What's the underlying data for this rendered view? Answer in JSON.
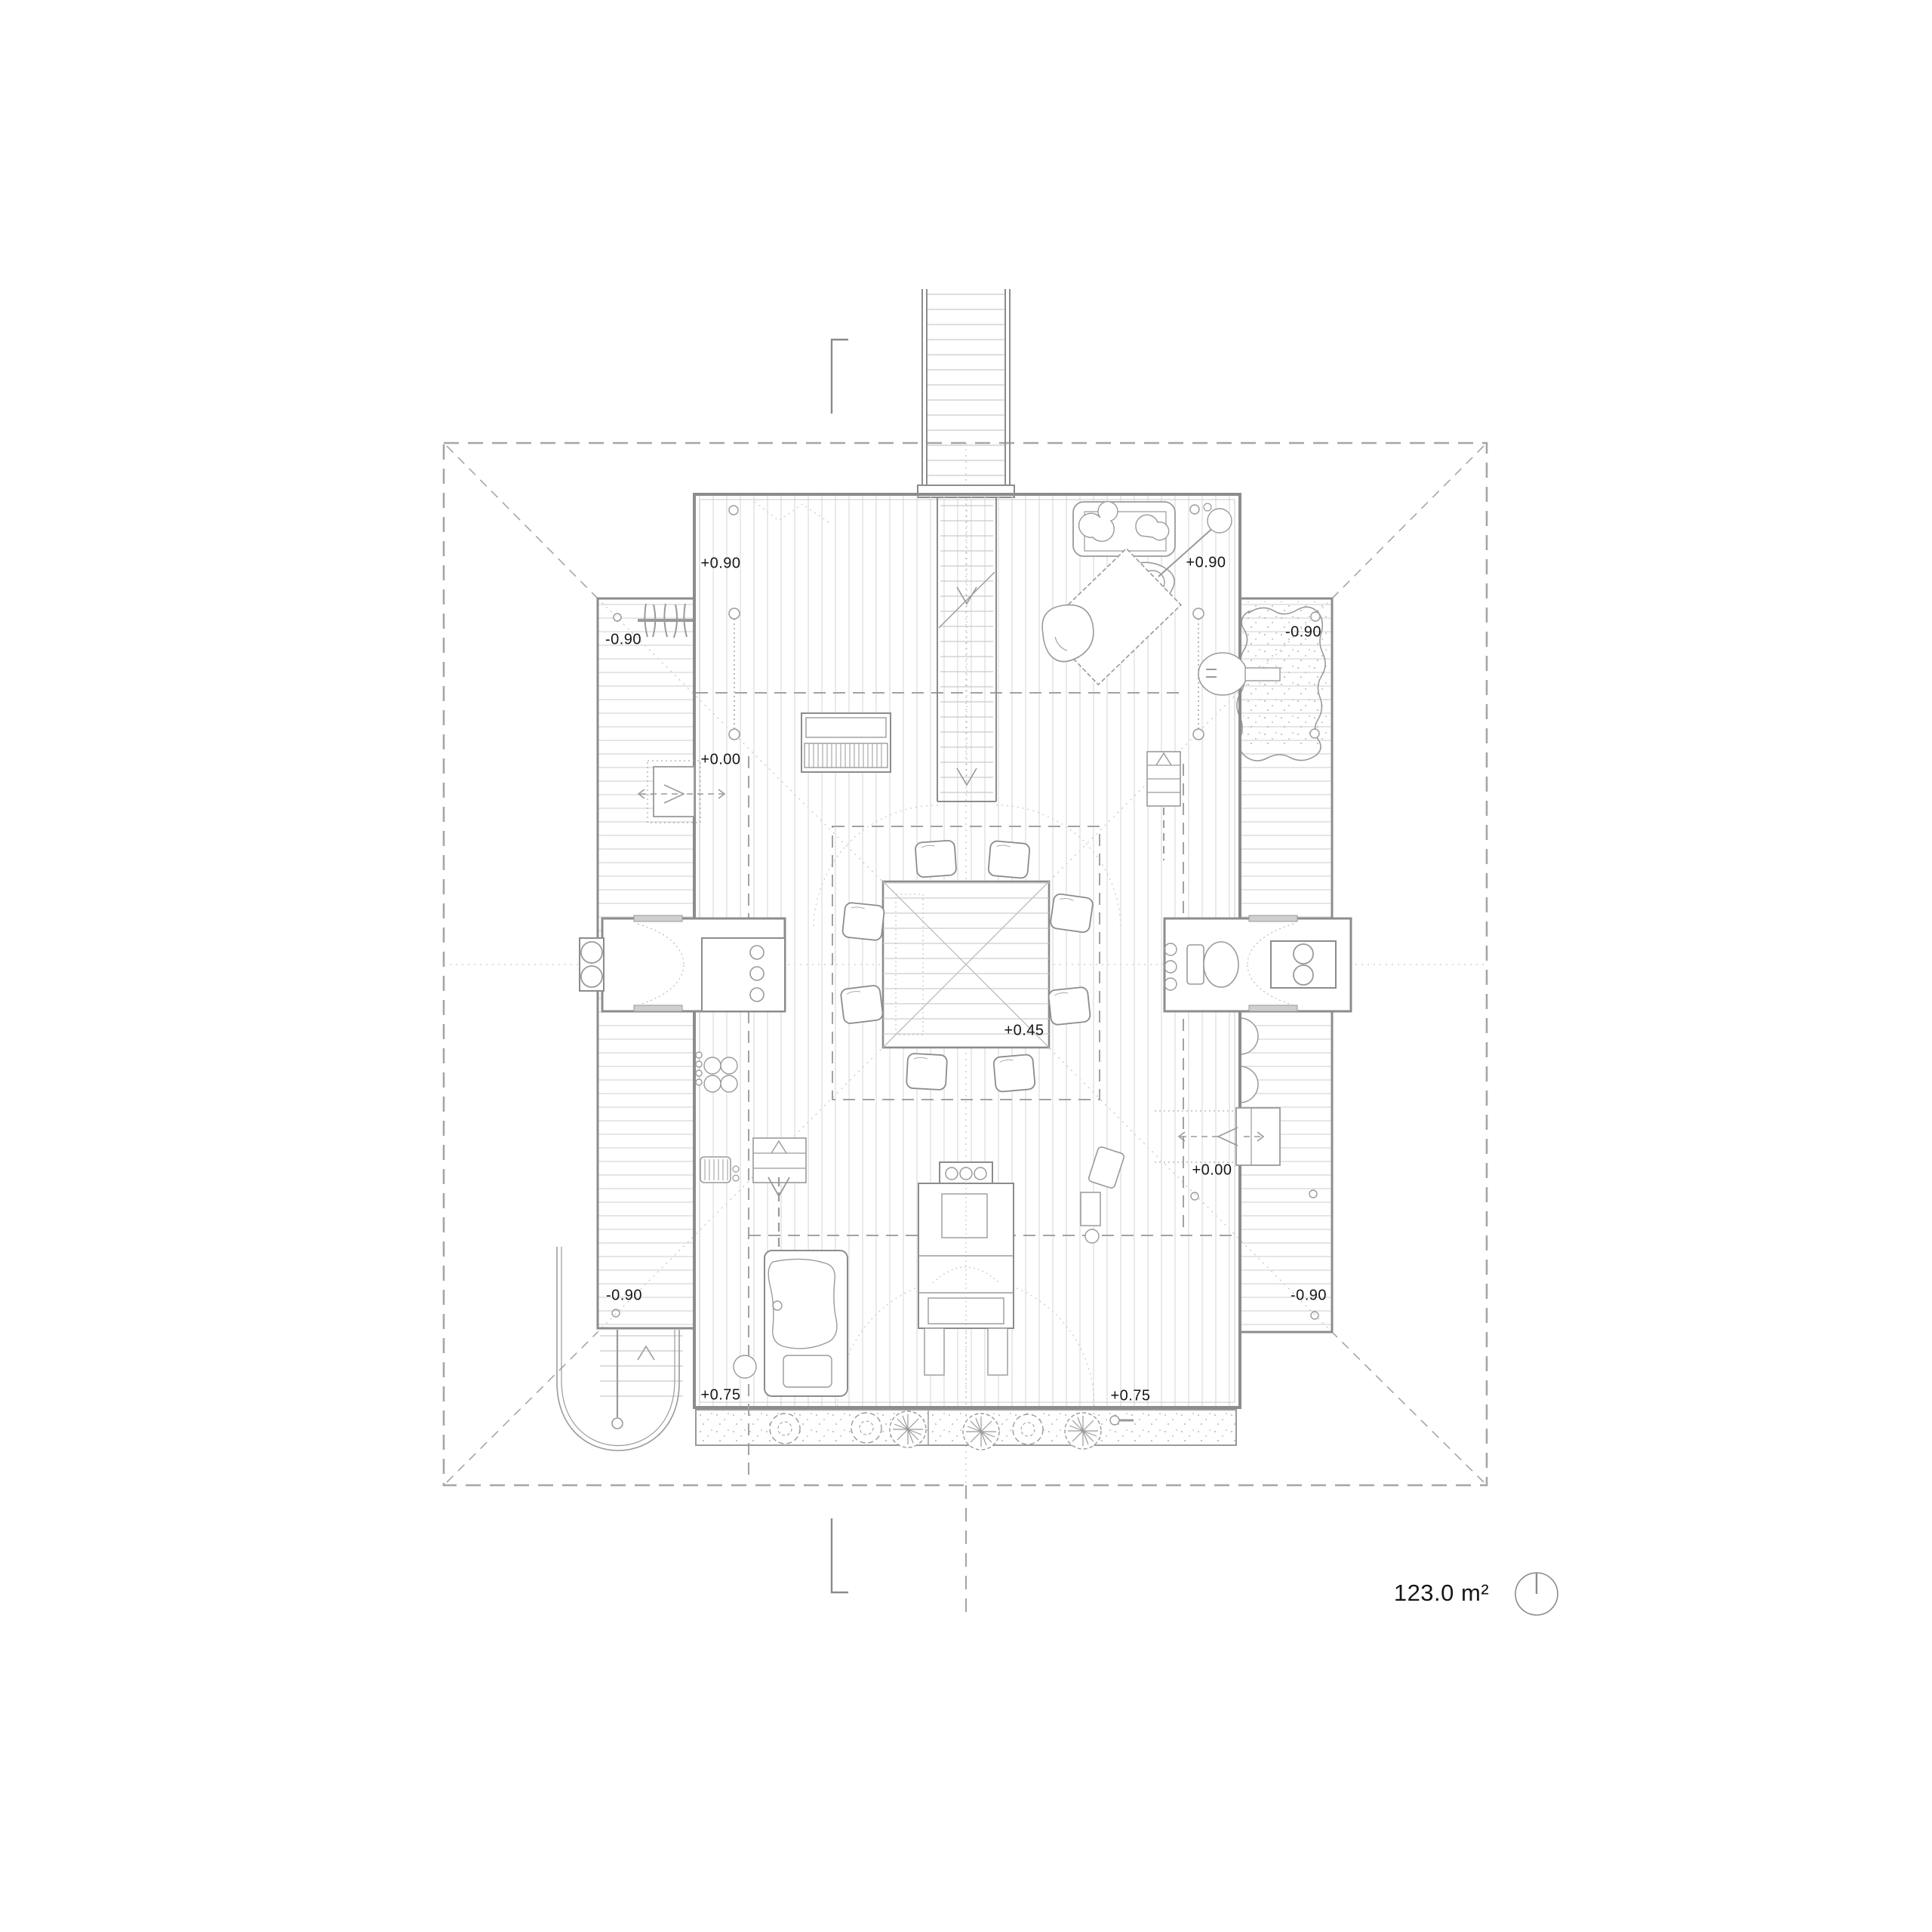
{
  "plan": {
    "area_label": "123.0 m²",
    "levels": [
      {
        "id": "upper-left",
        "text": "+0.90"
      },
      {
        "id": "upper-right",
        "text": "+0.90"
      },
      {
        "id": "left-wing-top",
        "text": "-0.90"
      },
      {
        "id": "right-wing-top",
        "text": "-0.90"
      },
      {
        "id": "mid-left",
        "text": "+0.00"
      },
      {
        "id": "platform",
        "text": "+0.45"
      },
      {
        "id": "mid-right",
        "text": "+0.00"
      },
      {
        "id": "left-wing-bottom",
        "text": "-0.90"
      },
      {
        "id": "right-wing-bottom",
        "text": "-0.90"
      },
      {
        "id": "terrace-left",
        "text": "+0.75"
      },
      {
        "id": "terrace-right",
        "text": "+0.75"
      }
    ],
    "symbols": {
      "north": "north-indicator",
      "section_marks": "section-cut-marks"
    },
    "colors": {
      "line_wall": "#8c8c8c",
      "line_plank": "#dcdcdc",
      "line_dashed": "#a6a6a6",
      "text": "#161616"
    }
  }
}
